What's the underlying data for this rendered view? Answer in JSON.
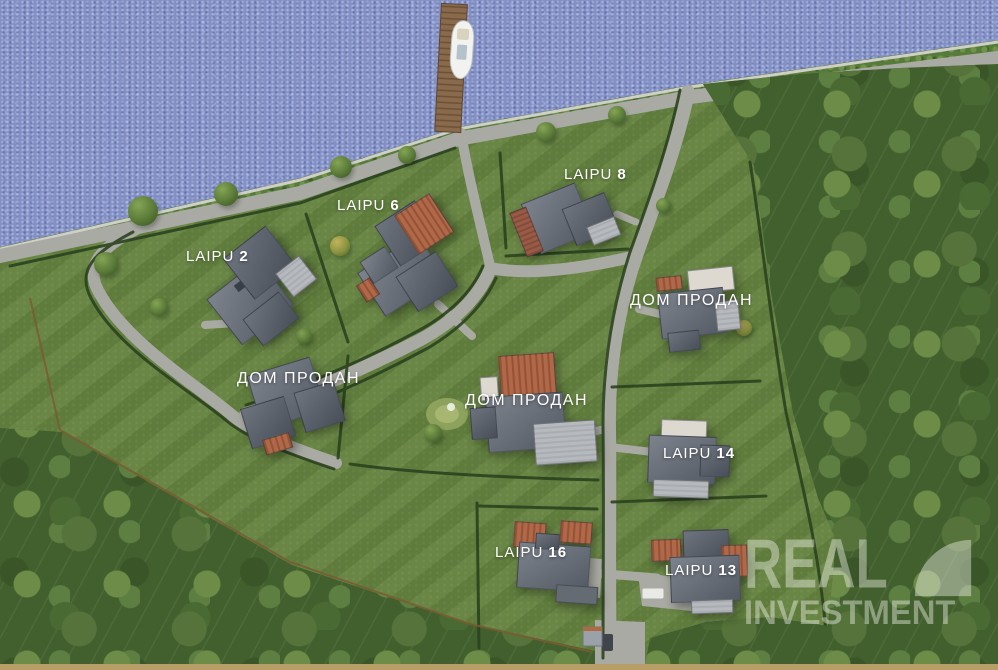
{
  "watermark": {
    "line1": "REAL",
    "line2": "INVESTMENT"
  },
  "lots": [
    {
      "id": "laipu-2",
      "label": "LAIPU",
      "number": "2"
    },
    {
      "id": "laipu-6",
      "label": "LAIPU",
      "number": "6"
    },
    {
      "id": "laipu-8",
      "label": "LAIPU",
      "number": "8"
    },
    {
      "id": "sold-east",
      "label": "ДОМ ПРОДАН",
      "number": ""
    },
    {
      "id": "sold-west",
      "label": "ДОМ ПРОДАН",
      "number": ""
    },
    {
      "id": "sold-center",
      "label": "ДОМ ПРОДАН",
      "number": ""
    },
    {
      "id": "laipu-14",
      "label": "LAIPU",
      "number": "14"
    },
    {
      "id": "laipu-16",
      "label": "LAIPU",
      "number": "16"
    },
    {
      "id": "laipu-13",
      "label": "LAIPU",
      "number": "13"
    }
  ],
  "colors": {
    "water": "#8290c6",
    "lawn": "#64823f",
    "forest": "#42602e",
    "road": "#a9aaa3",
    "hedge": "#2b431f",
    "fence": "#7b5a33",
    "pier": "#8a6a4c",
    "roofGray": "#6b717b",
    "roofOrange": "#b06848",
    "terrace": "#b6b9bd",
    "label": "#ffffff",
    "borderStrip": "#b79d66"
  }
}
